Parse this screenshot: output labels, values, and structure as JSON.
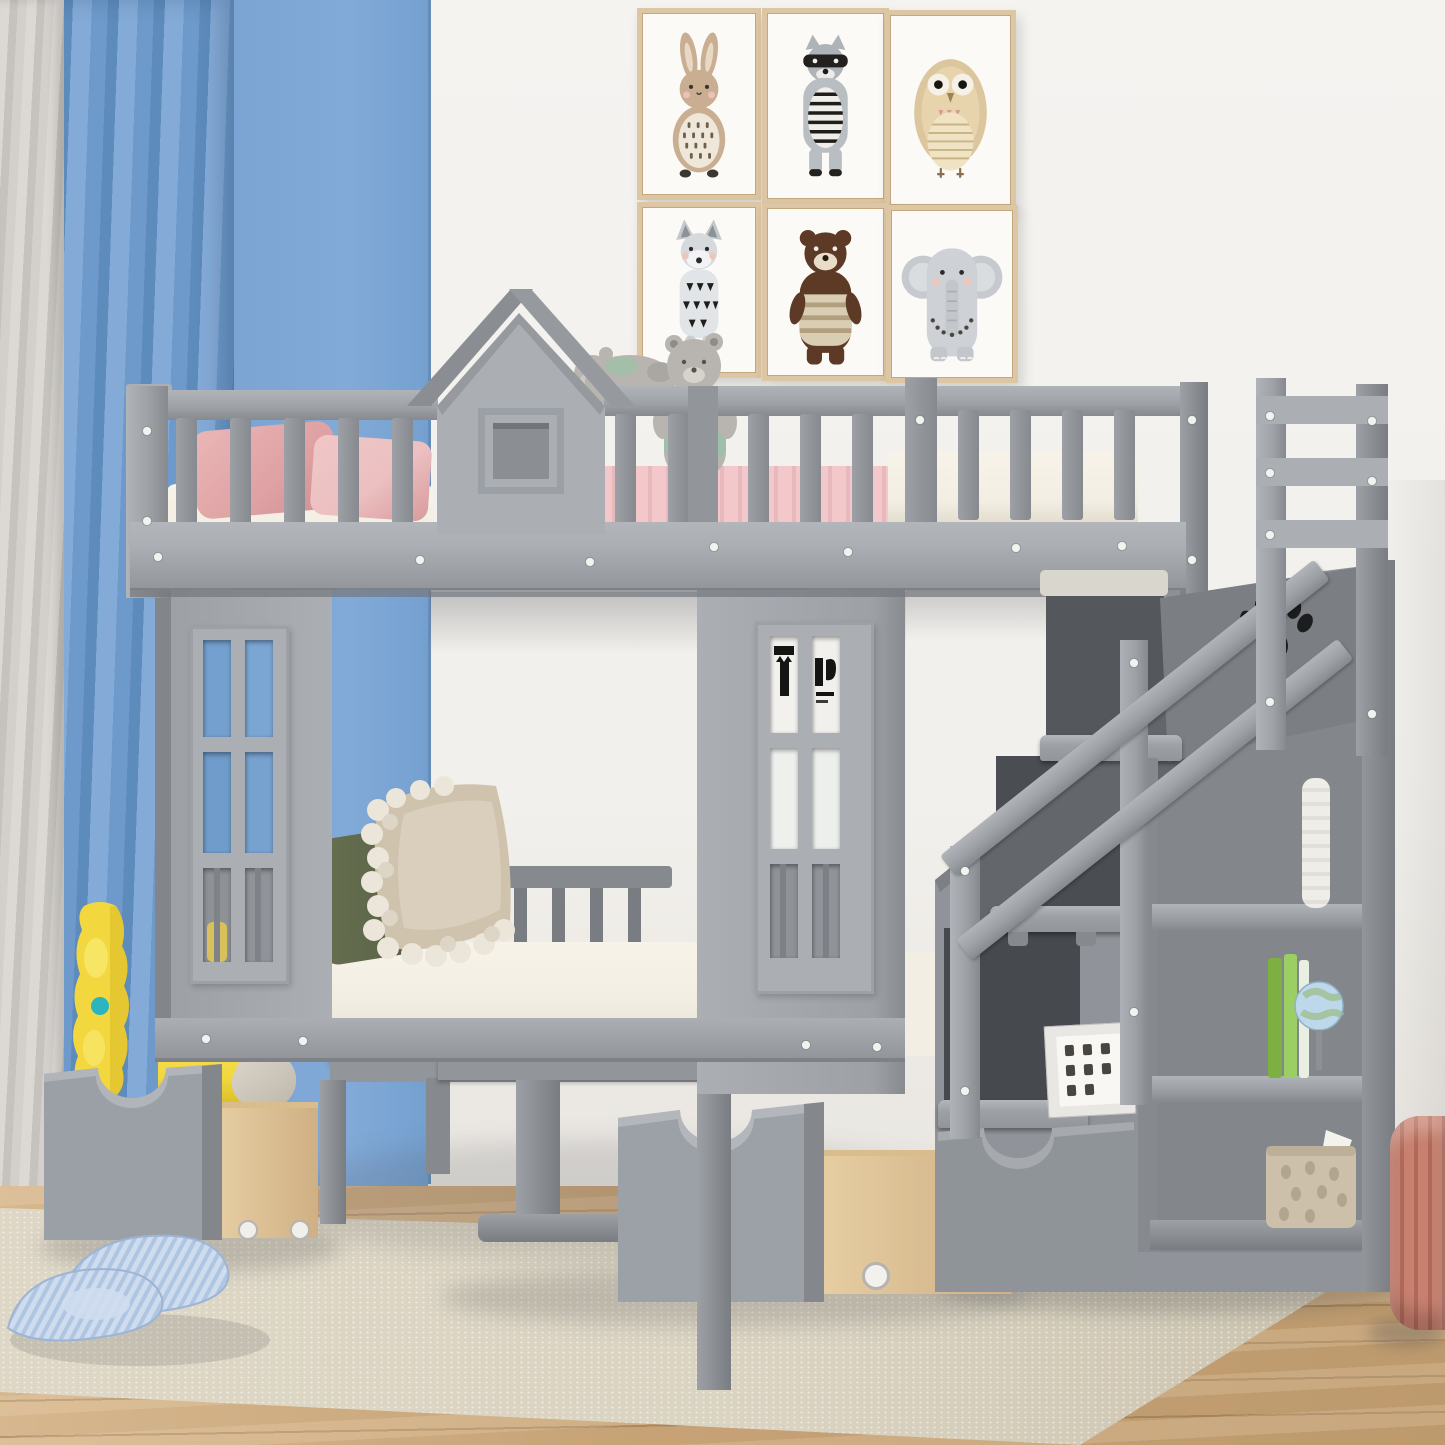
{
  "meta": {
    "title": "Kids bedroom product photo — gray house-style twin bunk bed with staircase storage, shelves and rolling drawers"
  },
  "palette": {
    "wall": "#f3f1ed",
    "blue-wall": "#7ba4d3",
    "blue-curtain": "#6d9aca",
    "blue-curtain-dark": "#5d8bbc",
    "blue-curtain-light": "#84abd7",
    "curtain-gray": "#d3d0cb",
    "curtain-gray-dark": "#c6c3be",
    "gray-0": "#abafb4",
    "gray-1": "#9da1a6",
    "gray-2": "#92969b",
    "gray-3": "#868a8f",
    "gray-4": "#797d82",
    "dark-0": "#54575c",
    "dark-1": "#4a4d52",
    "dark-2": "#3f4247",
    "mattress": "#f2eee3",
    "pink-pillow": "#dfa1a3",
    "pink-pillow-light": "#ecc0c1",
    "pink-blanket": "#f2c8cb",
    "red-blanket": "#8c4a42",
    "olive": "#5f684b",
    "beige-pillow": "#cfc3ae",
    "pompom": "#ece6da",
    "teddy": "#b8b4af",
    "teddy-shirt": "#9fc0a8",
    "wood-drawer": "#e6cda2",
    "wood-drawer-dark": "#cfb084",
    "floor": "#c6a276",
    "floor-light": "#d6b78e",
    "rug": "#dad3c1",
    "rug-dark": "#c9c1ad",
    "poster-frame": "#dcc6a3",
    "poster-frame-dark": "#c3a87f",
    "paper": "#fbfaf7",
    "yellow": "#f2d83e",
    "yellow-dark": "#d9ba26",
    "teal": "#2ab5c0",
    "slipper": "#cfdcee",
    "slipper-dark": "#aec6e2",
    "pouf": "#c8806f",
    "pouf-dark": "#b06a5b",
    "basket": "#cdc0aa",
    "basket-dark": "#b2a58d",
    "book-green-1": "#7cb043",
    "book-green-2": "#9ccf63",
    "globe": "#bcd8ea",
    "screw": "#f2f2f0",
    "bunny": "#c9ae92",
    "raccoon": "#aeb3b8",
    "owl": "#dcc69e",
    "fox": "#d6dadd",
    "bear": "#5d3a26",
    "elephant": "#ced2d6"
  },
  "wall_art": {
    "label": "six framed nursery animal prints",
    "animals": [
      "rabbit",
      "raccoon",
      "owl",
      "fox",
      "bear",
      "elephant"
    ]
  },
  "room": {
    "wall": "white wall",
    "accent": "blue accent wall with blue and gray curtains",
    "floor": "light oak wood floor",
    "rug": "beige woven rug"
  },
  "bed": {
    "label": "gray house-style bunk bed",
    "features": [
      "house roof headboard with square window",
      "upper guard rails with vertical slats",
      "two six-pane window panels",
      "staircase with handrail and paw-print cutout",
      "storage steps and side bookshelf",
      "two rolling under-bed drawers with natural wood boxes",
      "bottom staircase drawer",
      "lower level seating nook with pedestal table"
    ]
  },
  "bedding": {
    "upper": [
      "pink pillows",
      "pink knit blanket",
      "white mattress",
      "two gray teddy bears"
    ],
    "lower": [
      "white seat cushion",
      "beige pompom pillow",
      "olive green pillow"
    ]
  },
  "decor": {
    "shelf_items": [
      "rolled paper",
      "green books",
      "globe",
      "photo frame",
      "rabbit-print storage basket"
    ],
    "floor_items": [
      "yellow foam toy",
      "blue striped plush slippers",
      "coral knitted pouf"
    ]
  }
}
